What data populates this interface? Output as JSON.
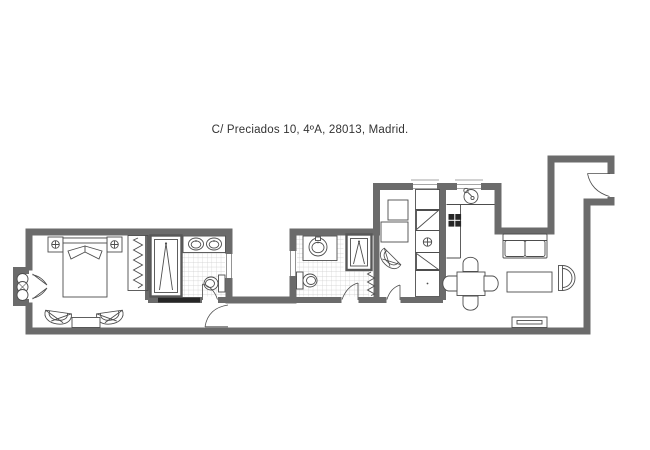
{
  "title": "C/ Preciados 10, 4ºA, 28013, Madrid.",
  "theme": {
    "wall": "#6b6b6b",
    "line": "#4d4d4d",
    "tile": "#c9c9c9",
    "paper": "#ffffff",
    "ink": "#333333",
    "threshold": "#262626"
  },
  "floor_plan": {
    "fixtures": [
      "double-bed",
      "nightstand-left",
      "nightstand-right",
      "lamp-symbol",
      "wardrobe-rail",
      "shower-1",
      "twin-sinks",
      "toilet-1",
      "bay-radiator",
      "french-doors",
      "armchair-left",
      "armchair-right",
      "side-table",
      "round-sink",
      "shower-2",
      "toilet-2",
      "towel-radiator",
      "hall-armchair",
      "tall-cabinet-unit",
      "pantry-cabinets",
      "kitchen-sink",
      "stove-burners",
      "kitchen-counter",
      "dining-table",
      "dining-chairs",
      "sofa",
      "coffee-table",
      "d-table",
      "sideboard",
      "entrance-door"
    ]
  }
}
